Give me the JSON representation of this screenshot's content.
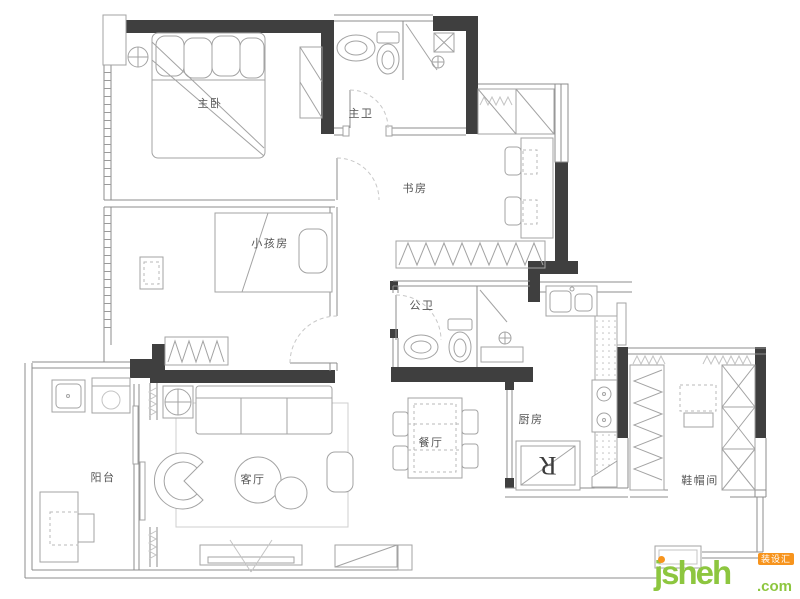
{
  "plan": {
    "rooms": {
      "master_bedroom": "主卧",
      "master_bath": "主卫",
      "study": "书房",
      "kids_room": "小孩房",
      "public_bath": "公卫",
      "balcony": "阳台",
      "living_room": "客厅",
      "dining_room": "餐厅",
      "kitchen": "厨房",
      "cloak_room": "鞋帽间"
    },
    "fridge_label": "R"
  },
  "watermark": {
    "site": "jsheh",
    "tld": ".com",
    "badge": "装设汇",
    "green": "#8dc63f",
    "orange": "#f7941d"
  },
  "colors": {
    "wall": "#3f3f3f",
    "line": "#8c8c8c",
    "background": "#ffffff"
  }
}
